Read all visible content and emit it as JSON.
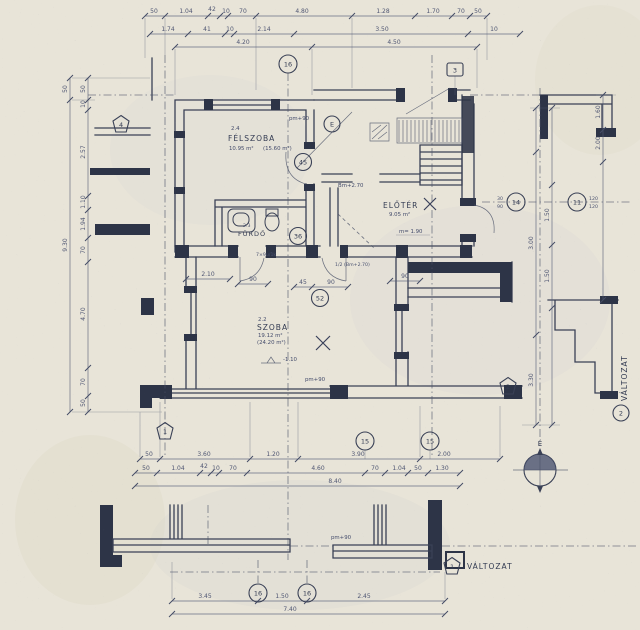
{
  "colors": {
    "paper": "#e8e4d8",
    "ink": "#3a4156",
    "ink_dark": "#2d3447",
    "ink_faint": "#5c637a"
  },
  "compass": {
    "north": "É"
  },
  "rooms": {
    "felszoba": {
      "num": "2.4",
      "name": "FÉLSZOBA",
      "area": "10.95 m²",
      "area_alt": "(15.60 m²)"
    },
    "eloter": {
      "name": "ELŐTÉR",
      "area": "9.05 m²",
      "height_note": "m= 1.90"
    },
    "furdo": {
      "num": "2.3",
      "name": "FÜRDŐ"
    },
    "szoba": {
      "num": "2.2",
      "name": "SZOBA",
      "area": "19.12 m²",
      "area_alt": "(24.20 m²)",
      "level_note": "-1.10"
    }
  },
  "notes": {
    "bm": "Bm+2.70",
    "bm_half": "1/2 (Bm+2.70)",
    "door_spec": "7×9u/1k",
    "pm_top": "pm+90",
    "pm_bottom": "pm+90",
    "pm_lower": "pm+90"
  },
  "markers": {
    "ref16_top": "16",
    "ref3": "3",
    "refE": "E",
    "ref45": "45",
    "ref14": "14",
    "ref11": "11",
    "ref36": "36",
    "ref52": "52",
    "ref15a": "15",
    "ref15b": "15",
    "ref16a": "16",
    "ref16b": "16",
    "pent1": "1",
    "pent2": "2",
    "pent4": "4",
    "variant1_num": "1",
    "variant1_label": "VÁLTOZAT",
    "variant2_num": "2",
    "variant2_label": "VÁLTOZAT",
    "stack_top": "30",
    "stack_bottom": "90",
    "stack2_top": "120",
    "stack2_bottom": "120"
  },
  "dims": {
    "top1": [
      "50",
      "1.04",
      "42",
      "10",
      "70",
      "4.80",
      "1.28",
      "1.70",
      "70",
      "50"
    ],
    "top2": [
      "1.74",
      "41",
      "10",
      "2.14",
      "3.50",
      "10"
    ],
    "top3": [
      "4.20",
      "4.50"
    ],
    "bottom1": [
      "50",
      "3.60",
      "1.20",
      "3.90",
      "2.00"
    ],
    "bottom2": [
      "50",
      "1.04",
      "42",
      "10",
      "70",
      "4.60",
      "70",
      "1.04",
      "50",
      "1.30"
    ],
    "bottom3": [
      "8.40"
    ],
    "lower1": [
      "3.45",
      "1.50",
      "2.45"
    ],
    "lower2": [
      "7.40"
    ],
    "left_outer": [
      "50",
      "9.30"
    ],
    "left_inner": [
      "50",
      "10",
      "2.57",
      "1.10",
      "1.94",
      "70",
      "4.70",
      "70",
      "50"
    ],
    "right_inner": [
      "3.00",
      "3.30"
    ],
    "right_mid": [
      "1.50",
      "1.50"
    ],
    "right_outer": [
      "1.60",
      "2.00"
    ],
    "doors": [
      "2.10",
      "90",
      "45",
      "90",
      "90"
    ]
  }
}
